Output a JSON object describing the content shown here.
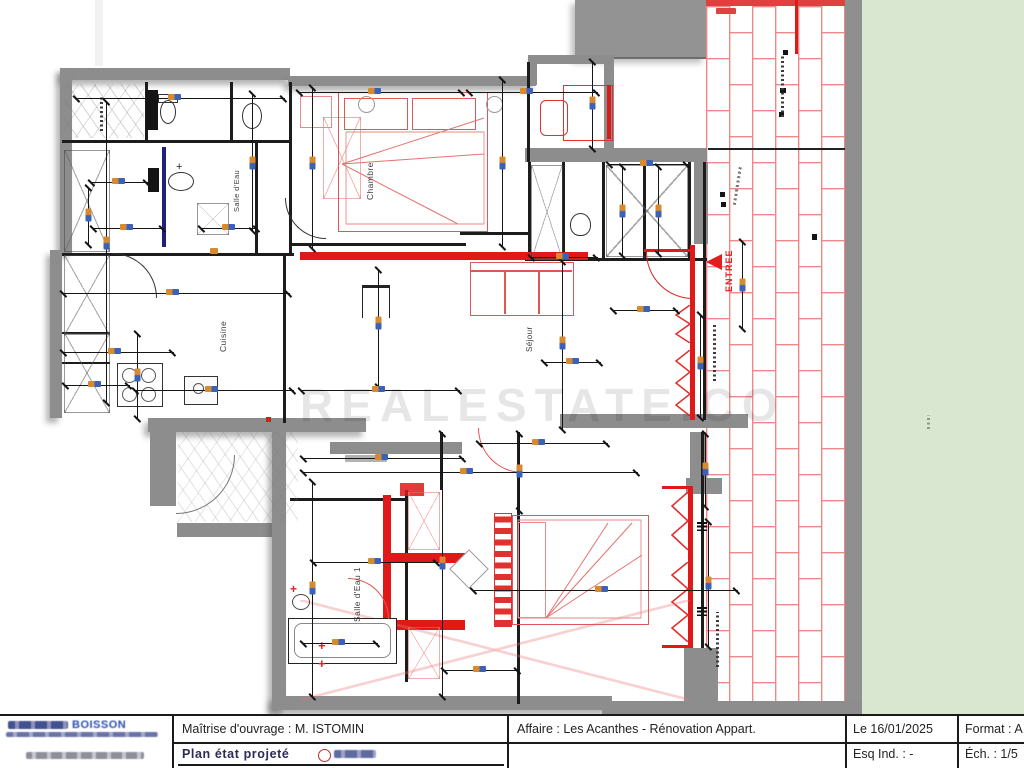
{
  "watermark": "REALESTATE.CO",
  "labels": {
    "chambre": "Chambre",
    "cuisine": "Cuisine",
    "salle_eau": "Salle d'Eau",
    "salle_eau_1": "Salle d'Eau 1",
    "sejour": "Séjour",
    "entree": "ENTREE"
  },
  "title_block": {
    "company": "BOISSON",
    "owner": "Maîtrise d'ouvrage : M. ISTOMIN",
    "plan_title": "Plan état projeté",
    "project": "Affaire : Les Acanthes - Rénovation Appart.",
    "date": "Le 16/01/2025",
    "esq_ind": "Esq Ind. : -",
    "format": "Format : A",
    "scale": "Éch. : 1/5"
  },
  "colors": {
    "new_wall_red": "#e01818",
    "existing_wall_gray": "#8d8d8d",
    "terrace_tile_red": "#ee8888",
    "lawn_green": "#d9e7d0",
    "dim_orange": "#d88b2e",
    "dim_blue": "#3b62b8"
  }
}
